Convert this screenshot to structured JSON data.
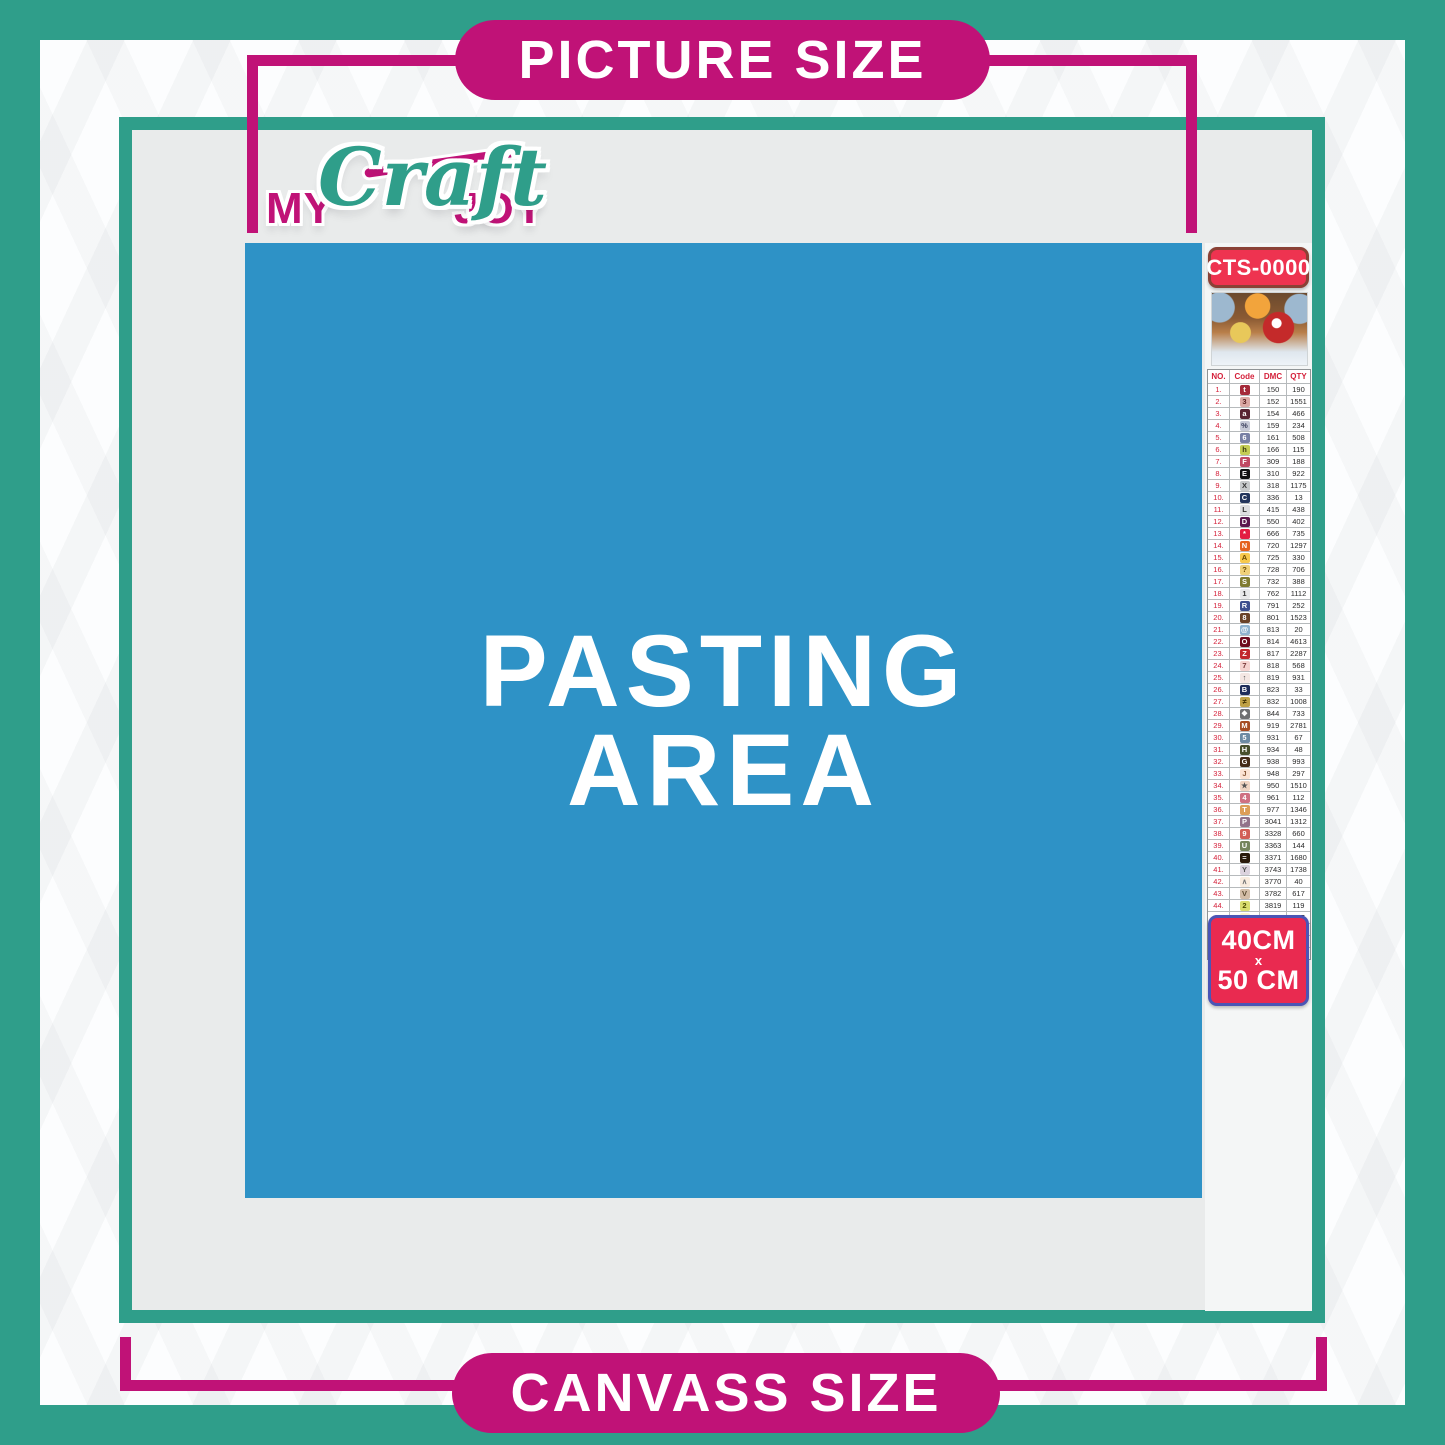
{
  "banners": {
    "top_label": "PICTURE SIZE",
    "bottom_label": "CANVASS SIZE"
  },
  "logo": {
    "part1": "MY",
    "part2": "Craft",
    "part3": "JOY"
  },
  "pasting_area": {
    "line1": "PASTING",
    "line2": "AREA"
  },
  "legend": {
    "sku": "CTS-0000",
    "thumbnail": "christmas-santa-sleigh-artwork",
    "table": {
      "headers": [
        "NO.",
        "Code",
        "DMC",
        "QTY"
      ],
      "rows": [
        {
          "no": "1.",
          "sym": "t",
          "bg": "#a52a3a",
          "fg": "#ffffff",
          "dmc": "150",
          "qty": "190"
        },
        {
          "no": "2.",
          "sym": "3",
          "bg": "#dba9a5",
          "fg": "#5a2020",
          "dmc": "152",
          "qty": "1551"
        },
        {
          "no": "3.",
          "sym": "a",
          "bg": "#572433",
          "fg": "#ffffff",
          "dmc": "154",
          "qty": "466"
        },
        {
          "no": "4.",
          "sym": "%",
          "bg": "#c7cad7",
          "fg": "#3a3f5c",
          "dmc": "159",
          "qty": "234"
        },
        {
          "no": "5.",
          "sym": "6",
          "bg": "#7880a4",
          "fg": "#ffffff",
          "dmc": "161",
          "qty": "508"
        },
        {
          "no": "6.",
          "sym": "h",
          "bg": "#c4cc54",
          "fg": "#3c3c10",
          "dmc": "166",
          "qty": "115"
        },
        {
          "no": "7.",
          "sym": "F",
          "bg": "#c04a63",
          "fg": "#ffffff",
          "dmc": "309",
          "qty": "188"
        },
        {
          "no": "8.",
          "sym": "E",
          "bg": "#111111",
          "fg": "#ffffff",
          "dmc": "310",
          "qty": "922"
        },
        {
          "no": "9.",
          "sym": "X",
          "bg": "#c6c9cb",
          "fg": "#333333",
          "dmc": "318",
          "qty": "1175"
        },
        {
          "no": "10.",
          "sym": "C",
          "bg": "#23355c",
          "fg": "#ffffff",
          "dmc": "336",
          "qty": "13"
        },
        {
          "no": "11.",
          "sym": "L",
          "bg": "#dddee0",
          "fg": "#333333",
          "dmc": "415",
          "qty": "438"
        },
        {
          "no": "12.",
          "sym": "D",
          "bg": "#5c184e",
          "fg": "#ffffff",
          "dmc": "550",
          "qty": "402"
        },
        {
          "no": "13.",
          "sym": "*",
          "bg": "#e31d42",
          "fg": "#ffffff",
          "dmc": "666",
          "qty": "735"
        },
        {
          "no": "14.",
          "sym": "N",
          "bg": "#e5631f",
          "fg": "#ffffff",
          "dmc": "720",
          "qty": "1297"
        },
        {
          "no": "15.",
          "sym": "A",
          "bg": "#f7c94d",
          "fg": "#6b4a00",
          "dmc": "725",
          "qty": "330"
        },
        {
          "no": "16.",
          "sym": "?",
          "bg": "#f0d17a",
          "fg": "#6b4a00",
          "dmc": "728",
          "qty": "706"
        },
        {
          "no": "17.",
          "sym": "S",
          "bg": "#7f7b2f",
          "fg": "#ffffff",
          "dmc": "732",
          "qty": "388"
        },
        {
          "no": "18.",
          "sym": "1",
          "bg": "#e8e9ea",
          "fg": "#333333",
          "dmc": "762",
          "qty": "1112"
        },
        {
          "no": "19.",
          "sym": "R",
          "bg": "#3d4f8f",
          "fg": "#ffffff",
          "dmc": "791",
          "qty": "252"
        },
        {
          "no": "20.",
          "sym": "8",
          "bg": "#6a4227",
          "fg": "#ffffff",
          "dmc": "801",
          "qty": "1523"
        },
        {
          "no": "21.",
          "sym": "@",
          "bg": "#8fb3cf",
          "fg": "#ffffff",
          "dmc": "813",
          "qty": "20"
        },
        {
          "no": "22.",
          "sym": "O",
          "bg": "#6e0b1e",
          "fg": "#ffffff",
          "dmc": "814",
          "qty": "4613"
        },
        {
          "no": "23.",
          "sym": "Z",
          "bg": "#c1272d",
          "fg": "#ffffff",
          "dmc": "817",
          "qty": "2287"
        },
        {
          "no": "24.",
          "sym": "7",
          "bg": "#f6d3cf",
          "fg": "#7a3a3a",
          "dmc": "818",
          "qty": "568"
        },
        {
          "no": "25.",
          "sym": "↑",
          "bg": "#f4e7e3",
          "fg": "#555555",
          "dmc": "819",
          "qty": "931"
        },
        {
          "no": "26.",
          "sym": "B",
          "bg": "#1f2d5a",
          "fg": "#ffffff",
          "dmc": "823",
          "qty": "33"
        },
        {
          "no": "27.",
          "sym": "≠",
          "bg": "#bfa145",
          "fg": "#3f3000",
          "dmc": "832",
          "qty": "1008"
        },
        {
          "no": "28.",
          "sym": "❖",
          "bg": "#6f7072",
          "fg": "#ffffff",
          "dmc": "844",
          "qty": "733"
        },
        {
          "no": "29.",
          "sym": "M",
          "bg": "#a74d24",
          "fg": "#ffffff",
          "dmc": "919",
          "qty": "2781"
        },
        {
          "no": "30.",
          "sym": "5",
          "bg": "#6d8ba3",
          "fg": "#ffffff",
          "dmc": "931",
          "qty": "67"
        },
        {
          "no": "31.",
          "sym": "H",
          "bg": "#474f2c",
          "fg": "#ffffff",
          "dmc": "934",
          "qty": "48"
        },
        {
          "no": "32.",
          "sym": "G",
          "bg": "#442a18",
          "fg": "#ffffff",
          "dmc": "938",
          "qty": "993"
        },
        {
          "no": "33.",
          "sym": "J",
          "bg": "#fbe3d4",
          "fg": "#8a5a3a",
          "dmc": "948",
          "qty": "297"
        },
        {
          "no": "34.",
          "sym": "★",
          "bg": "#f0d5c3",
          "fg": "#555555",
          "dmc": "950",
          "qty": "1510"
        },
        {
          "no": "35.",
          "sym": "4",
          "bg": "#cf7082",
          "fg": "#ffffff",
          "dmc": "961",
          "qty": "112"
        },
        {
          "no": "36.",
          "sym": "T",
          "bg": "#dc9e58",
          "fg": "#ffffff",
          "dmc": "977",
          "qty": "1346"
        },
        {
          "no": "37.",
          "sym": "P",
          "bg": "#92738a",
          "fg": "#ffffff",
          "dmc": "3041",
          "qty": "1312"
        },
        {
          "no": "38.",
          "sym": "9",
          "bg": "#d25f57",
          "fg": "#ffffff",
          "dmc": "3328",
          "qty": "660"
        },
        {
          "no": "39.",
          "sym": "U",
          "bg": "#75855c",
          "fg": "#ffffff",
          "dmc": "3363",
          "qty": "144"
        },
        {
          "no": "40.",
          "sym": "=",
          "bg": "#2a190b",
          "fg": "#ffffff",
          "dmc": "3371",
          "qty": "1680"
        },
        {
          "no": "41.",
          "sym": "Y",
          "bg": "#dcd3de",
          "fg": "#555555",
          "dmc": "3743",
          "qty": "1738"
        },
        {
          "no": "42.",
          "sym": "∧",
          "bg": "#f9ecdf",
          "fg": "#777777",
          "dmc": "3770",
          "qty": "40"
        },
        {
          "no": "43.",
          "sym": "V",
          "bg": "#d3bda7",
          "fg": "#5a4a30",
          "dmc": "3782",
          "qty": "617"
        },
        {
          "no": "44.",
          "sym": "2",
          "bg": "#dadd70",
          "fg": "#4a4a00",
          "dmc": "3819",
          "qty": "119"
        },
        {
          "no": "45.",
          "sym": "✓",
          "bg": "#fdf4d0",
          "fg": "#777777",
          "dmc": "3823",
          "qty": "107"
        },
        {
          "no": "46.",
          "sym": "C",
          "bg": "#ee8e4f",
          "fg": "#ffffff",
          "dmc": "3853",
          "qty": "1332"
        },
        {
          "no": "47.",
          "sym": "K",
          "bg": "#774139",
          "fg": "#ffffff",
          "dmc": "3858",
          "qty": "2311"
        },
        {
          "no": "48.",
          "sym": "A",
          "bg": "#a5865f",
          "fg": "#ffffff",
          "dmc": "3863",
          "qty": "1820"
        }
      ]
    },
    "size_badge": {
      "line1": "40CM",
      "line2": "x",
      "line3": "50 CM"
    }
  },
  "colors": {
    "teal": "#2f9e8a",
    "pink": "#c01277",
    "blue": "#2e92c6",
    "badge_red": "#ee3350",
    "picture_bg": "#e9ebeb",
    "strip_bg": "#f4f6f6"
  }
}
